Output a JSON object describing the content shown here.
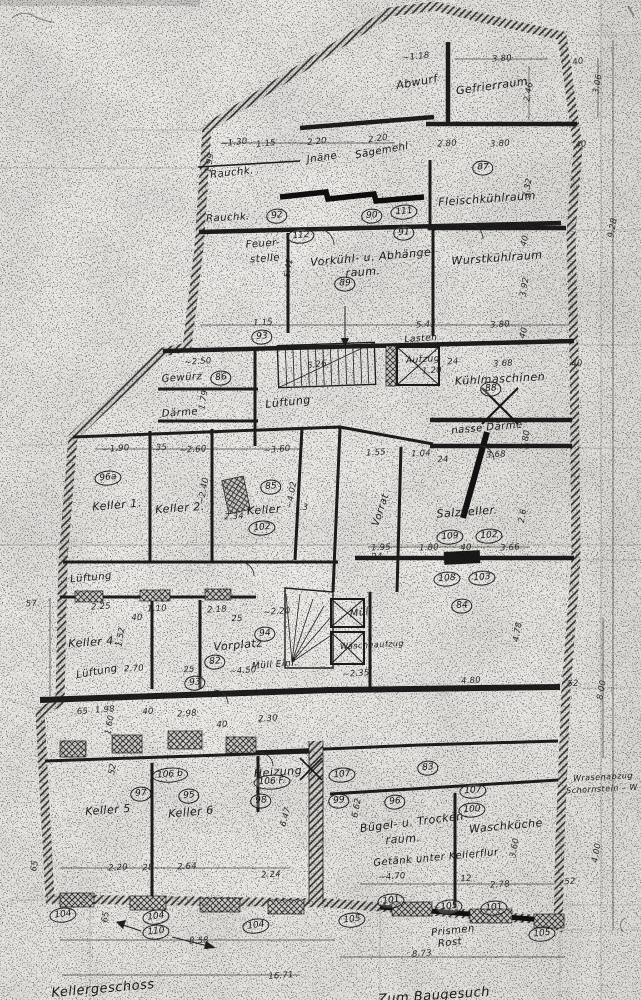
{
  "sheet": {
    "colors": {
      "paper": "#ebe9e5",
      "ink": "#1e1e1e",
      "wall_hatch": "#dcd9d4"
    }
  },
  "labels": {
    "rooms": [
      {
        "text": "Abwurf",
        "x": 417,
        "y": 82,
        "rot": -10
      },
      {
        "text": "Gefrierraum",
        "x": 492,
        "y": 86,
        "rot": -8
      },
      {
        "text": "Jnäne",
        "x": 322,
        "y": 158,
        "rot": -8,
        "size": 10
      },
      {
        "text": "Sägemehl",
        "x": 382,
        "y": 151,
        "rot": -10,
        "size": 10
      },
      {
        "text": "Rauchk.",
        "x": 232,
        "y": 173,
        "rot": -6,
        "size": 10
      },
      {
        "text": "Rauchk.",
        "x": 228,
        "y": 218,
        "rot": -3,
        "size": 10
      },
      {
        "text": "Feuer-",
        "x": 263,
        "y": 244,
        "rot": -4,
        "size": 10
      },
      {
        "text": "stelle",
        "x": 265,
        "y": 259,
        "rot": -4,
        "size": 10
      },
      {
        "text": "Vorkühl- u. Abhänge-",
        "x": 373,
        "y": 257,
        "rot": -5
      },
      {
        "text": "raum.",
        "x": 363,
        "y": 272,
        "rot": -4
      },
      {
        "text": "Fleischkühlraum",
        "x": 487,
        "y": 199,
        "rot": -4
      },
      {
        "text": "Wurstkühlraum",
        "x": 497,
        "y": 258,
        "rot": -4
      },
      {
        "text": "Lasten",
        "x": 421,
        "y": 339,
        "rot": -4,
        "size": 9
      },
      {
        "text": "Aufzug",
        "x": 423,
        "y": 360,
        "rot": -4,
        "size": 9
      },
      {
        "text": "Kühlmaschinen",
        "x": 500,
        "y": 379,
        "rot": -3
      },
      {
        "text": "nasse Därme",
        "x": 487,
        "y": 428,
        "rot": -5,
        "size": 10
      },
      {
        "text": "Gewürz",
        "x": 182,
        "y": 378,
        "rot": -4,
        "size": 10
      },
      {
        "text": "Lüftung",
        "x": 288,
        "y": 402,
        "rot": -6
      },
      {
        "text": "Därme",
        "x": 180,
        "y": 413,
        "rot": -4,
        "size": 10
      },
      {
        "text": "Keller 1.",
        "x": 117,
        "y": 505,
        "rot": -5
      },
      {
        "text": "Keller 2.",
        "x": 180,
        "y": 508,
        "rot": -4
      },
      {
        "text": "Keller",
        "x": 264,
        "y": 510,
        "rot": -4
      },
      {
        "text": "Vorrat",
        "x": 381,
        "y": 510,
        "rot": -72,
        "size": 10
      },
      {
        "text": "Salzkeller.",
        "x": 467,
        "y": 512,
        "rot": -4
      },
      {
        "text": "Lüftung",
        "x": 91,
        "y": 578,
        "rot": -5,
        "size": 10
      },
      {
        "text": "Keller 4.",
        "x": 93,
        "y": 642,
        "rot": -4
      },
      {
        "text": "Lüftung",
        "x": 97,
        "y": 672,
        "rot": -10,
        "size": 10
      },
      {
        "text": "Vorplatz",
        "x": 238,
        "y": 645,
        "rot": -5
      },
      {
        "text": "Müll Einf.",
        "x": 275,
        "y": 665,
        "rot": -4,
        "size": 9
      },
      {
        "text": "Müll",
        "x": 361,
        "y": 613,
        "rot": -8,
        "size": 10
      },
      {
        "text": "Wäscheaufzug",
        "x": 372,
        "y": 645,
        "rot": -3,
        "size": 8
      },
      {
        "text": "Keller 5",
        "x": 108,
        "y": 810,
        "rot": -4
      },
      {
        "text": "Keller 6",
        "x": 191,
        "y": 812,
        "rot": -5
      },
      {
        "text": "Heizung",
        "x": 278,
        "y": 772,
        "rot": -4
      },
      {
        "text": "Bügel- u. Trocken-",
        "x": 414,
        "y": 822,
        "rot": -7
      },
      {
        "text": "raum.",
        "x": 403,
        "y": 839,
        "rot": -4
      },
      {
        "text": "Waschküche",
        "x": 506,
        "y": 826,
        "rot": -5
      },
      {
        "text": "Getänk unter Kellerflur",
        "x": 436,
        "y": 858,
        "rot": -5,
        "size": 10
      },
      {
        "text": "Prismen",
        "x": 453,
        "y": 931,
        "rot": -6,
        "size": 10
      },
      {
        "text": "Rost",
        "x": 450,
        "y": 943,
        "rot": -6,
        "size": 10
      },
      {
        "text": "Wrasenabzug",
        "x": 603,
        "y": 777,
        "rot": -3,
        "size": 8
      },
      {
        "text": "Schornstein – W",
        "x": 602,
        "y": 789,
        "rot": -3,
        "size": 8
      },
      {
        "text": "Kellergeschoss",
        "x": 103,
        "y": 989,
        "rot": -5,
        "size": 13
      },
      {
        "text": "Zum Baugesuch",
        "x": 434,
        "y": 996,
        "rot": -4,
        "size": 13
      }
    ],
    "numbers": [
      {
        "text": "87",
        "x": 483,
        "y": 168
      },
      {
        "text": "92",
        "x": 277,
        "y": 216,
        "rot": -6
      },
      {
        "text": "90",
        "x": 372,
        "y": 216,
        "rot": -4
      },
      {
        "text": "111",
        "x": 404,
        "y": 212,
        "rot": -5
      },
      {
        "text": "112",
        "x": 301,
        "y": 236,
        "rot": -5
      },
      {
        "text": "91",
        "x": 404,
        "y": 233,
        "rot": -3
      },
      {
        "text": "89",
        "x": 345,
        "y": 284
      },
      {
        "text": "93",
        "x": 262,
        "y": 337,
        "rot": -4
      },
      {
        "text": "86",
        "x": 221,
        "y": 378,
        "rot": -4
      },
      {
        "text": "88",
        "x": 491,
        "y": 389,
        "rot": -3
      },
      {
        "text": "96a",
        "x": 108,
        "y": 478,
        "rot": -5
      },
      {
        "text": "85",
        "x": 271,
        "y": 487,
        "rot": -4
      },
      {
        "text": "102",
        "x": 262,
        "y": 528,
        "rot": -5
      },
      {
        "text": "109",
        "x": 450,
        "y": 537,
        "rot": -4
      },
      {
        "text": "102",
        "x": 489,
        "y": 536,
        "rot": -4
      },
      {
        "text": "108",
        "x": 447,
        "y": 579,
        "rot": -4
      },
      {
        "text": "103",
        "x": 482,
        "y": 578,
        "rot": -4
      },
      {
        "text": "84",
        "x": 462,
        "y": 606,
        "rot": -3
      },
      {
        "text": "94",
        "x": 265,
        "y": 634,
        "rot": -4
      },
      {
        "text": "82",
        "x": 215,
        "y": 662,
        "rot": -4
      },
      {
        "text": "93",
        "x": 195,
        "y": 683,
        "rot": -5
      },
      {
        "text": "83",
        "x": 428,
        "y": 768,
        "rot": -4
      },
      {
        "text": "106 b",
        "x": 170,
        "y": 775,
        "rot": -4
      },
      {
        "text": "97",
        "x": 141,
        "y": 794,
        "rot": -4
      },
      {
        "text": "95",
        "x": 189,
        "y": 796,
        "rot": -4
      },
      {
        "text": "106 F.",
        "x": 272,
        "y": 782,
        "rot": -3
      },
      {
        "text": "98",
        "x": 261,
        "y": 801,
        "rot": -3
      },
      {
        "text": "107",
        "x": 342,
        "y": 775,
        "rot": -5
      },
      {
        "text": "99",
        "x": 339,
        "y": 801,
        "rot": -4
      },
      {
        "text": "96",
        "x": 395,
        "y": 802,
        "rot": -4
      },
      {
        "text": "107",
        "x": 473,
        "y": 791,
        "rot": -4
      },
      {
        "text": "100",
        "x": 472,
        "y": 810,
        "rot": -4
      },
      {
        "text": "104",
        "x": 63,
        "y": 915,
        "rot": -6
      },
      {
        "text": "104",
        "x": 156,
        "y": 917,
        "rot": -8
      },
      {
        "text": "110",
        "x": 156,
        "y": 932,
        "rot": -5
      },
      {
        "text": "104",
        "x": 256,
        "y": 926,
        "rot": -8
      },
      {
        "text": "101",
        "x": 391,
        "y": 901,
        "rot": -6
      },
      {
        "text": "105",
        "x": 449,
        "y": 907,
        "rot": -6
      },
      {
        "text": "101",
        "x": 494,
        "y": 908,
        "rot": -5
      },
      {
        "text": "105",
        "x": 352,
        "y": 920,
        "rot": -6
      },
      {
        "text": "105",
        "x": 542,
        "y": 934,
        "rot": -6
      }
    ],
    "dims": [
      {
        "text": "~1.18",
        "x": 416,
        "y": 57,
        "rot": -6
      },
      {
        "text": "3.80",
        "x": 502,
        "y": 59,
        "rot": -4
      },
      {
        "text": "40",
        "x": 578,
        "y": 62,
        "rot": -10
      },
      {
        "text": "2.46",
        "x": 529,
        "y": 92,
        "rot": -80
      },
      {
        "text": "3.06",
        "x": 598,
        "y": 84,
        "rot": -80
      },
      {
        "text": "9.28",
        "x": 613,
        "y": 228,
        "rot": -80
      },
      {
        "text": "3.80",
        "x": 500,
        "y": 144,
        "rot": -4
      },
      {
        "text": "2.80",
        "x": 447,
        "y": 144,
        "rot": -4
      },
      {
        "text": "40",
        "x": 581,
        "y": 145,
        "rot": -8
      },
      {
        "text": "~1.30",
        "x": 234,
        "y": 143,
        "rot": -6
      },
      {
        "text": "1.15",
        "x": 266,
        "y": 144,
        "rot": -6
      },
      {
        "text": "2.20",
        "x": 317,
        "y": 142,
        "rot": -6
      },
      {
        "text": "2.20",
        "x": 378,
        "y": 139,
        "rot": -8
      },
      {
        "text": "1.99",
        "x": 210,
        "y": 163,
        "rot": -80
      },
      {
        "text": "3.32",
        "x": 528,
        "y": 188,
        "rot": -80
      },
      {
        "text": "40",
        "x": 525,
        "y": 241,
        "rot": -75
      },
      {
        "text": "3.92",
        "x": 525,
        "y": 287,
        "rot": -80
      },
      {
        "text": "5.42",
        "x": 289,
        "y": 268,
        "rot": -82
      },
      {
        "text": "5.43",
        "x": 426,
        "y": 325,
        "rot": -3
      },
      {
        "text": "1.15",
        "x": 263,
        "y": 323,
        "rot": -3
      },
      {
        "text": "3.80",
        "x": 500,
        "y": 325,
        "rot": -3
      },
      {
        "text": "40",
        "x": 524,
        "y": 333,
        "rot": -75
      },
      {
        "text": "~2.50",
        "x": 198,
        "y": 362,
        "rot": -4
      },
      {
        "text": "5.26",
        "x": 317,
        "y": 365,
        "rot": -8
      },
      {
        "text": "1.79",
        "x": 204,
        "y": 400,
        "rot": -80
      },
      {
        "text": "24",
        "x": 453,
        "y": 362,
        "rot": -4
      },
      {
        "text": "3.68",
        "x": 503,
        "y": 364,
        "rot": -3
      },
      {
        "text": "40",
        "x": 577,
        "y": 364,
        "rot": -6
      },
      {
        "text": "1.20",
        "x": 432,
        "y": 371,
        "rot": -4
      },
      {
        "text": "1.80",
        "x": 526,
        "y": 440,
        "rot": -80
      },
      {
        "text": "~1.90",
        "x": 116,
        "y": 449,
        "rot": -4
      },
      {
        "text": ".35",
        "x": 160,
        "y": 448,
        "rot": -3
      },
      {
        "text": "~2.60",
        "x": 193,
        "y": 450,
        "rot": -4
      },
      {
        "text": "~3.60",
        "x": 277,
        "y": 450,
        "rot": -5
      },
      {
        "text": "~2.40",
        "x": 204,
        "y": 491,
        "rot": -80
      },
      {
        "text": "~4.02",
        "x": 292,
        "y": 495,
        "rot": -80
      },
      {
        "text": "2.34",
        "x": 234,
        "y": 517,
        "rot": -3
      },
      {
        "text": ".3",
        "x": 304,
        "y": 508,
        "rot": 0
      },
      {
        "text": "1.55",
        "x": 376,
        "y": 453,
        "rot": -4
      },
      {
        "text": "1.04",
        "x": 421,
        "y": 454,
        "rot": -3
      },
      {
        "text": "3.68",
        "x": 496,
        "y": 455,
        "rot": -3
      },
      {
        "text": "24",
        "x": 443,
        "y": 460,
        "rot": -3
      },
      {
        "text": "2.6",
        "x": 523,
        "y": 516,
        "rot": -80
      },
      {
        "text": "1.95",
        "x": 381,
        "y": 548,
        "rot": -3
      },
      {
        "text": "1.80",
        "x": 429,
        "y": 548,
        "rot": -3
      },
      {
        "text": "40",
        "x": 466,
        "y": 548,
        "rot": -3
      },
      {
        "text": "3.66",
        "x": 510,
        "y": 548,
        "rot": -3
      },
      {
        "text": "24",
        "x": 377,
        "y": 557,
        "rot": -3
      },
      {
        "text": "4.78",
        "x": 518,
        "y": 632,
        "rot": -80
      },
      {
        "text": "4.80",
        "x": 471,
        "y": 681,
        "rot": -4
      },
      {
        "text": "52",
        "x": 573,
        "y": 684,
        "rot": -3
      },
      {
        "text": "8.00",
        "x": 602,
        "y": 690,
        "rot": -80
      },
      {
        "text": "2.18",
        "x": 217,
        "y": 610,
        "rot": -4
      },
      {
        "text": "25",
        "x": 237,
        "y": 619,
        "rot": -3
      },
      {
        "text": "~2.20",
        "x": 277,
        "y": 612,
        "rot": -4
      },
      {
        "text": "2.25",
        "x": 101,
        "y": 607,
        "rot": -4
      },
      {
        "text": "1.10",
        "x": 157,
        "y": 609,
        "rot": -3
      },
      {
        "text": "40",
        "x": 137,
        "y": 618,
        "rot": -3
      },
      {
        "text": "1.52",
        "x": 121,
        "y": 637,
        "rot": -80
      },
      {
        "text": "2.70",
        "x": 134,
        "y": 669,
        "rot": -3
      },
      {
        "text": "25",
        "x": 189,
        "y": 670,
        "rot": -3
      },
      {
        "text": "~4.50",
        "x": 243,
        "y": 671,
        "rot": -4
      },
      {
        "text": "~2.35",
        "x": 356,
        "y": 674,
        "rot": -4
      },
      {
        "text": ".65",
        "x": 81,
        "y": 712,
        "rot": -3
      },
      {
        "text": "1.98",
        "x": 105,
        "y": 710,
        "rot": -4
      },
      {
        "text": "40",
        "x": 148,
        "y": 712,
        "rot": -3
      },
      {
        "text": "2.98",
        "x": 187,
        "y": 714,
        "rot": -4
      },
      {
        "text": "1.60",
        "x": 110,
        "y": 725,
        "rot": -80
      },
      {
        "text": "40",
        "x": 222,
        "y": 725,
        "rot": -3
      },
      {
        "text": "2.30",
        "x": 268,
        "y": 719,
        "rot": -4
      },
      {
        "text": "52",
        "x": 113,
        "y": 769,
        "rot": -80
      },
      {
        "text": "6.47",
        "x": 286,
        "y": 817,
        "rot": -75
      },
      {
        "text": "6.62",
        "x": 357,
        "y": 808,
        "rot": -80
      },
      {
        "text": "~4.70",
        "x": 392,
        "y": 877,
        "rot": -4
      },
      {
        "text": "12",
        "x": 466,
        "y": 879,
        "rot": -3
      },
      {
        "text": "2.78",
        "x": 500,
        "y": 885,
        "rot": -4
      },
      {
        "text": "3.60",
        "x": 515,
        "y": 848,
        "rot": -80
      },
      {
        "text": "4.00",
        "x": 597,
        "y": 853,
        "rot": -80
      },
      {
        "text": "52",
        "x": 570,
        "y": 882,
        "rot": -3
      },
      {
        "text": "2.20",
        "x": 118,
        "y": 868,
        "rot": -3
      },
      {
        "text": "28",
        "x": 148,
        "y": 868,
        "rot": -3
      },
      {
        "text": "2.64",
        "x": 187,
        "y": 867,
        "rot": -3
      },
      {
        "text": "2.24",
        "x": 271,
        "y": 875,
        "rot": -4
      },
      {
        "text": "65",
        "x": 35,
        "y": 866,
        "rot": -80
      },
      {
        "text": "65",
        "x": 106,
        "y": 917,
        "rot": -80
      },
      {
        "text": "8.58",
        "x": 199,
        "y": 941,
        "rot": -4
      },
      {
        "text": "16.71",
        "x": 281,
        "y": 976,
        "rot": -4
      },
      {
        "text": "8.73",
        "x": 422,
        "y": 954,
        "rot": -4
      },
      {
        "text": "57.",
        "x": 33,
        "y": 604,
        "rot": -3
      }
    ]
  }
}
